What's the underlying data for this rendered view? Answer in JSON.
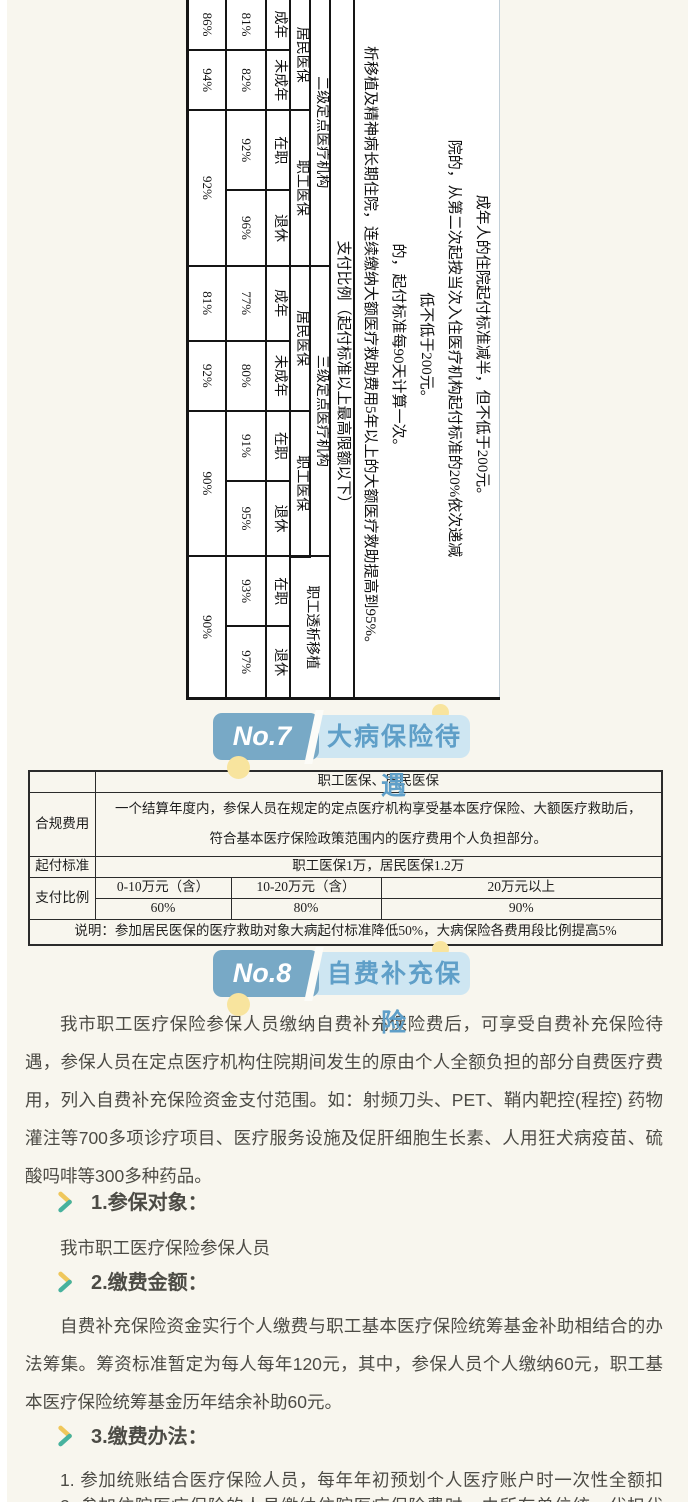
{
  "colors": {
    "page_bg": "#F8F6EE",
    "banner_dark": "#78A9C6",
    "banner_light": "#CEE6F2",
    "banner_title": "#5F9FC8",
    "dot_yellow": "#F8E49E",
    "body_text": "#4C4B45",
    "chevron_yellow": "#EFC75B",
    "chevron_teal": "#47B29E"
  },
  "rt": {
    "notes": [
      "成年人的住院起付标准减半，但不低于200元。",
      "院的，从第二次起按当次入住医疗机构起付标准的20%依次递减",
      "低不低于200元。",
      "的，起付标准每90天计算一次。",
      "析移植及精神病长期住院，连续缴纳大额医疗救助费用5年以上的大额医疗救助提高到95%。"
    ],
    "header": "支付比例（起付标准以上最高限额以下）",
    "cat": [
      "二级定点医疗机构",
      "三级定点医疗机构",
      "职工透析移植"
    ],
    "ins": [
      "居民医保",
      "职工医保",
      "居民医保",
      "职工医保"
    ],
    "grp": [
      "成年",
      "未成年",
      "在职",
      "退休",
      "成年",
      "未成年",
      "在职",
      "退休",
      "在职",
      "退休"
    ],
    "row1": [
      "81%",
      "82%",
      "92%",
      "96%",
      "77%",
      "80%",
      "91%",
      "95%",
      "93%",
      "97%"
    ],
    "row2": [
      "86%",
      "94%",
      "92%",
      "81%",
      "92%",
      "90%",
      "90%"
    ]
  },
  "s7": {
    "badge": "No.7",
    "title": "大病保险待遇",
    "table": {
      "header": "职工医保、居民医保",
      "label_cost": "合规费用",
      "cost_line1": "一个结算年度内，参保人员在规定的定点医疗机构享受基本医疗保险、大额医疗救助后，",
      "cost_line2": "符合基本医疗保险政策范围内的医疗费用个人负担部分。",
      "label_deductible": "起付标准",
      "deductible_value": "职工医保1万，居民医保1.2万",
      "label_ratio": "支付比例",
      "tiers": [
        "0-10万元（含）",
        "10-20万元（含）",
        "20万元以上"
      ],
      "rates": [
        "60%",
        "80%",
        "90%"
      ],
      "note": "说明：参加居民医保的医疗救助对象大病起付标准降低50%，大病保险各费用段比例提高5%"
    }
  },
  "s8": {
    "badge": "No.8",
    "title": "自费补充保险",
    "intro": "我市职工医疗保险参保人员缴纳自费补充保险费后，可享受自费补充保险待遇，参保人员在定点医疗机构住院期间发生的原由个人全额负担的部分自费医疗费用，列入自费补充保险资金支付范围。如：射频刀头、PET、鞘内靶控(程控) 药物灌注等700多项诊疗项目、医疗服务设施及促肝细胞生长素、人用狂犬病疫苗、硫酸吗啡等300多种药品。",
    "h1": "1.参保对象：",
    "p_object": "我市职工医疗保险参保人员",
    "h2": "2.缴费金额：",
    "p_money": "自费补充保险资金实行个人缴费与职工基本医疗保险统筹基金补助相结合的办法筹集。筹资标准暂定为每人每年120元，其中，参保人员个人缴纳60元，职工基本医疗保险统筹基金历年结余补助60元。",
    "h3": "3.缴费办法：",
    "p_method1": "1. 参加统账结合医疗保险人员，每年年初预划个人医疗账户时一次性全额扣缴。",
    "p_method2_partial": "2. 参加住院医疗保险的人员缴纳住院医疗保险费时，由所在单位统一代扣代缴。"
  }
}
